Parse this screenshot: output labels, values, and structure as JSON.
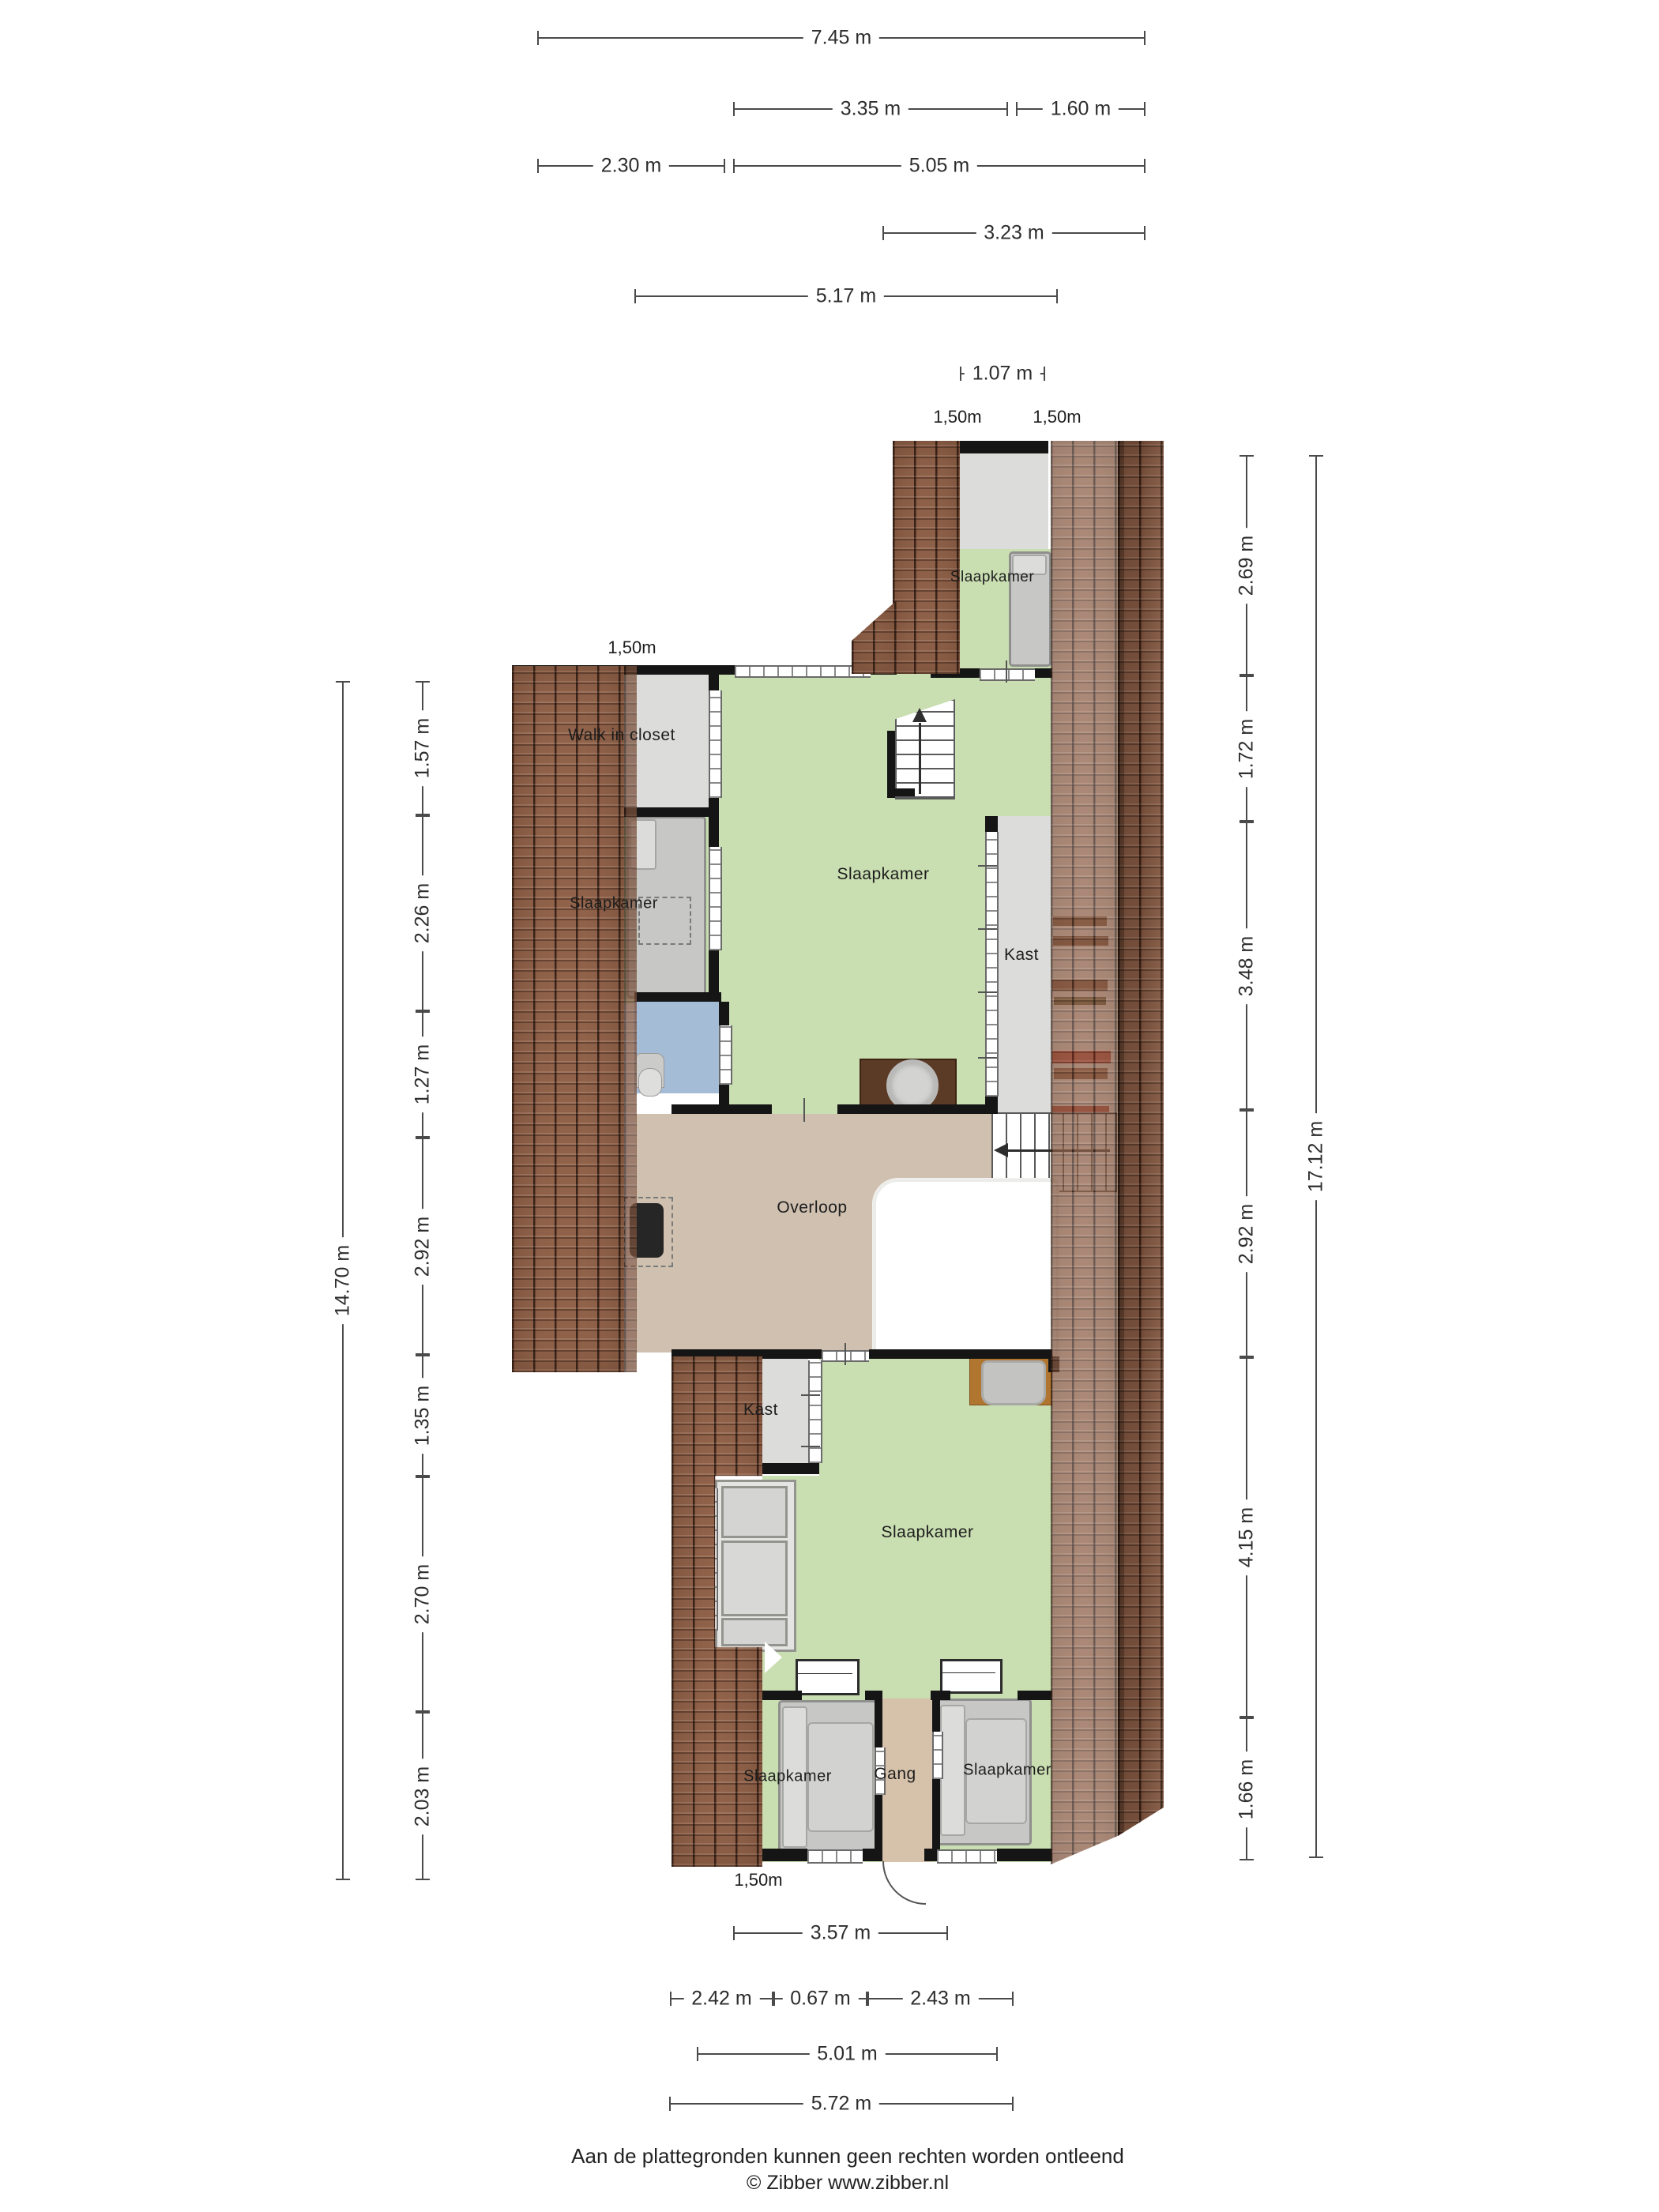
{
  "rooms": [
    {
      "id": "slaapkamer-top",
      "label": "Slaapkamer"
    },
    {
      "id": "walk-in-closet",
      "label": "Walk in closet"
    },
    {
      "id": "slaapkamer-center",
      "label": "Slaapkamer"
    },
    {
      "id": "slaapkamer-left",
      "label": "Slaapkamer"
    },
    {
      "id": "kast-center",
      "label": "Kast"
    },
    {
      "id": "overloop",
      "label": "Overloop"
    },
    {
      "id": "kast-small",
      "label": "Kast"
    },
    {
      "id": "slaapkamer-lower",
      "label": "Slaapkamer"
    },
    {
      "id": "slaapkamer-bottom-left",
      "label": "Slaapkamer"
    },
    {
      "id": "gang",
      "label": "Gang"
    },
    {
      "id": "slaapkamer-bottom-right",
      "label": "Slaapkamer"
    }
  ],
  "meter_marks": [
    "1,50m",
    "1,50m",
    "1,50m",
    "1,50m"
  ],
  "dims": {
    "top": [
      "7.45 m",
      "3.35 m",
      "1.60 m",
      "2.30 m",
      "5.05 m",
      "3.23 m",
      "5.17 m",
      "1.07 m"
    ],
    "bottom": [
      "3.57 m",
      "2.42 m",
      "0.67 m",
      "2.43 m",
      "5.01 m",
      "5.72 m"
    ],
    "left": [
      "1.57 m",
      "2.26 m",
      "1.27 m",
      "2.92 m",
      "1.35 m",
      "2.70 m",
      "2.03 m",
      "14.70 m"
    ],
    "right": [
      "2.69 m",
      "1.72 m",
      "3.48 m",
      "2.92 m",
      "4.15 m",
      "1.66 m",
      "17.12 m"
    ]
  },
  "footer": {
    "line1": "Aan de plattegronden kunnen geen rechten worden ontleend",
    "line2": "© Zibber www.zibber.nl"
  },
  "colors": {
    "green": "#c9deb1",
    "floor_gray": "#dcdcda",
    "tan": "#cfc0b0",
    "gang_tan": "#d6c2ab",
    "blue": "#a5bcd6",
    "roof": "#96664d",
    "wall": "#151515",
    "bed_gray": "#c7c7c5",
    "wood_dark": "#5b3a26",
    "wood_orange": "#b0762f",
    "dim_line": "#4a4a4a"
  }
}
